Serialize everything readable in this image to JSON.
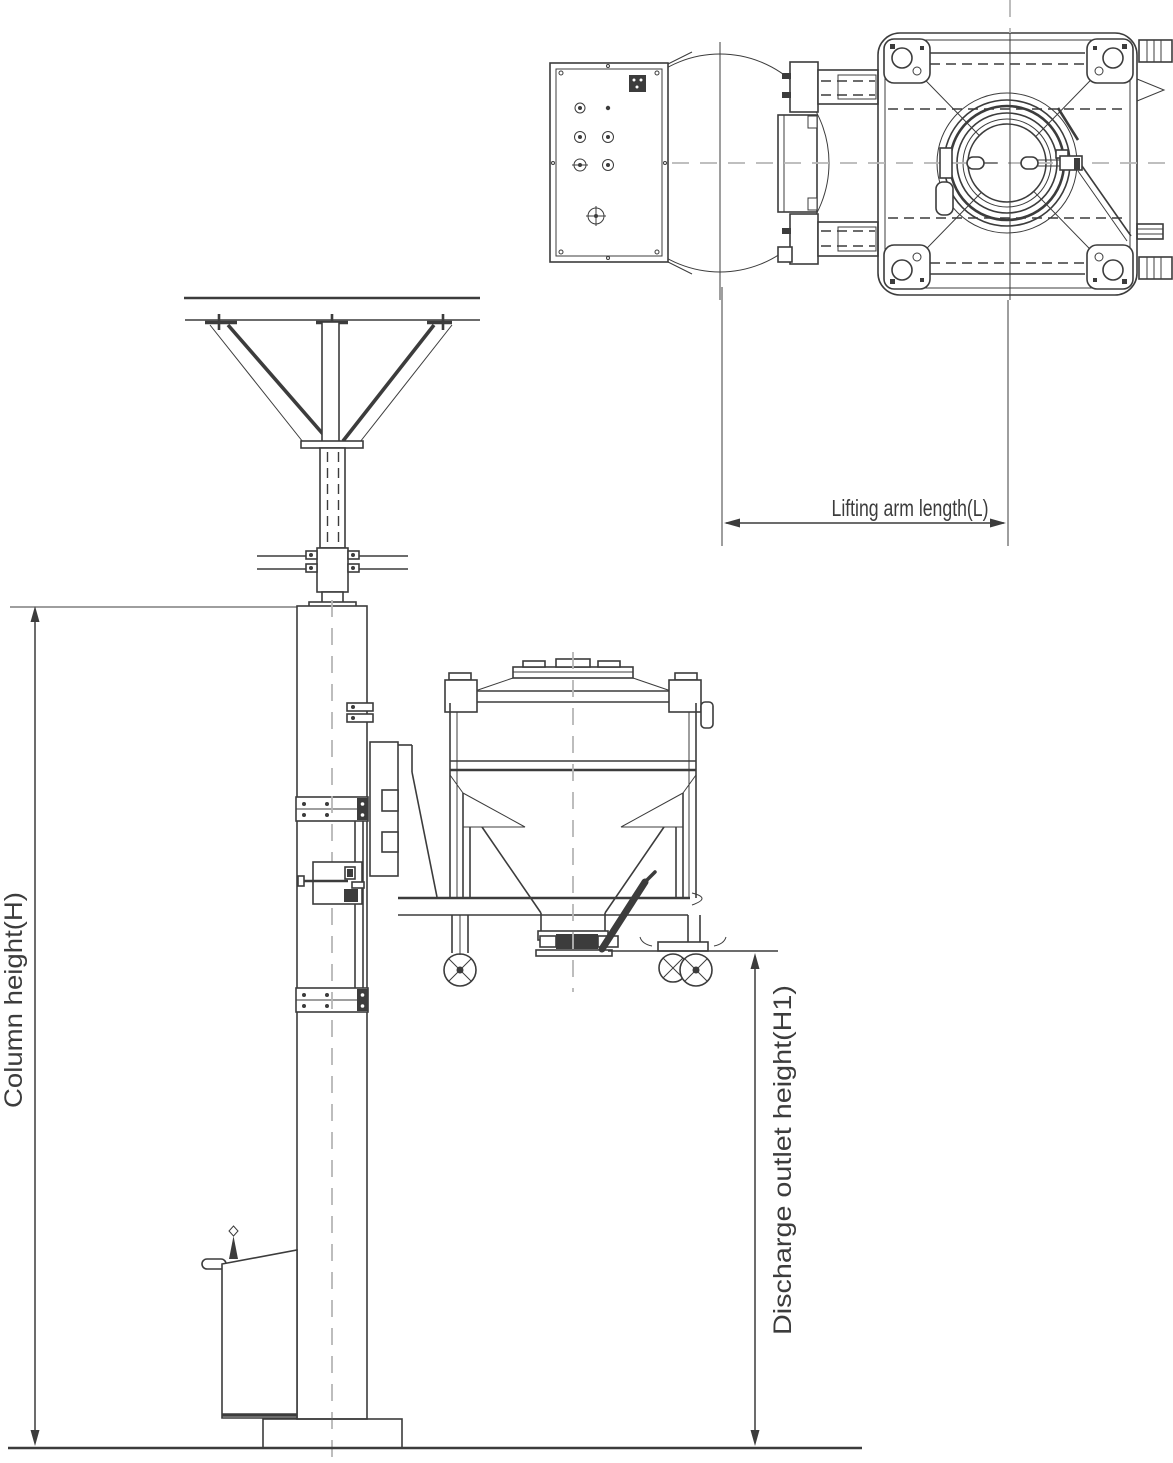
{
  "labels": {
    "lifting_arm_length": "Lifting arm length(L)",
    "column_height": "Column height(H)",
    "discharge_outlet_height": "Discharge outlet height(H1)"
  },
  "colors": {
    "line": "#3c3c3c",
    "centerline": "#b6b6b6",
    "background": "#ffffff"
  }
}
